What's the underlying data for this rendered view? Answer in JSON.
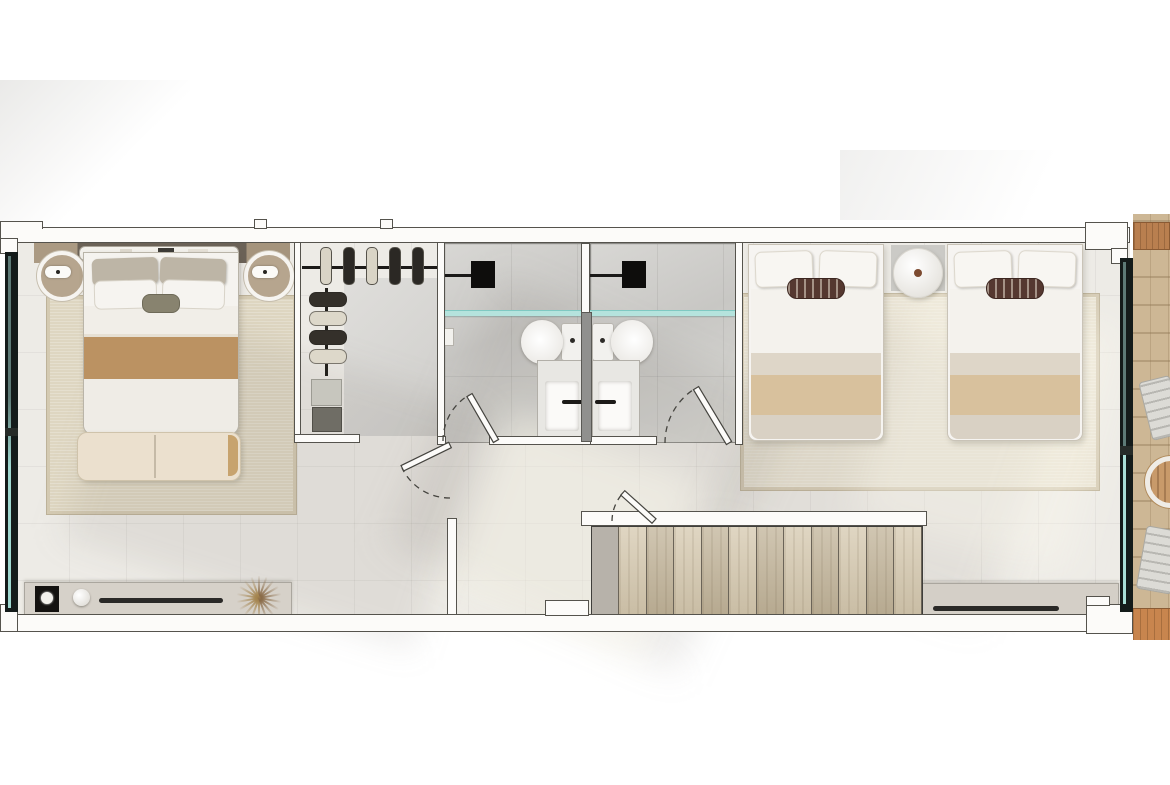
{
  "scene": {
    "kind": "upper-floor-plan-top-view-render",
    "background": "#ffffff"
  },
  "palette": {
    "wall": "#fcfbf9",
    "wall_line": "#55534d",
    "floor": "#edebe6",
    "bath_floor": "#cfcecb",
    "glass": "#a9ded6",
    "glass_frame": "#151c1b",
    "shower_fixture": "#0e0d0c",
    "rug_master": "#ded6c1",
    "rug_twin": "#e9e3d3",
    "blanket_tan": "#bb9262",
    "blanket_twin_tan": "#d8c19d",
    "bench": "#ebe0ce",
    "stair_light": "#d5c8ae",
    "stair_dark": "#c1b398",
    "stair_landing": "#b7b2aa",
    "stone": "#cdb795",
    "beam_wood": "#b97f4f",
    "deck_wood": "#c8854e",
    "console": "#d6d1c9",
    "tv_bar": "#2a2927",
    "cream": "#d9d4c6",
    "dark": "#2b2824",
    "shoe_dark": "#34302a",
    "shoe_cream": "#ddd8ca",
    "pillow_brown": "#553830",
    "lamp_base": "#b6a58e",
    "table_dot": "#7c4a30"
  },
  "stairs": {
    "tread_count": 11,
    "tread_colors": [
      "#d5c8ae",
      "#c1b398"
    ],
    "landing_color": "#b7b2aa"
  },
  "closet": {
    "hanging": {
      "items": [
        "cream",
        "dark",
        "cream",
        "dark",
        "dark"
      ]
    },
    "shoes": {
      "items": [
        "shoe_dark",
        "shoe_cream",
        "shoe_dark",
        "shoe_cream"
      ]
    },
    "folded_stacks": 2
  },
  "plant": {
    "rays": {
      "count": 9
    }
  },
  "bedrooms": {
    "master": {
      "beds": 1,
      "nightstands": 2,
      "bench": 1,
      "console_items": [
        "tray",
        "vase",
        "tv-bar",
        "dried-plant"
      ]
    },
    "twin": {
      "beds": 2,
      "side_table": 1,
      "console_items": [
        "tv-bar"
      ]
    }
  },
  "bathrooms": {
    "count": 2,
    "fixtures_each": [
      "rain-shower",
      "glass-screen",
      "toilet",
      "vanity-sink"
    ],
    "doors": 2
  },
  "terrace": {
    "loungers": 2,
    "round_table": 1,
    "beam": 1,
    "deck_strip": 1
  }
}
